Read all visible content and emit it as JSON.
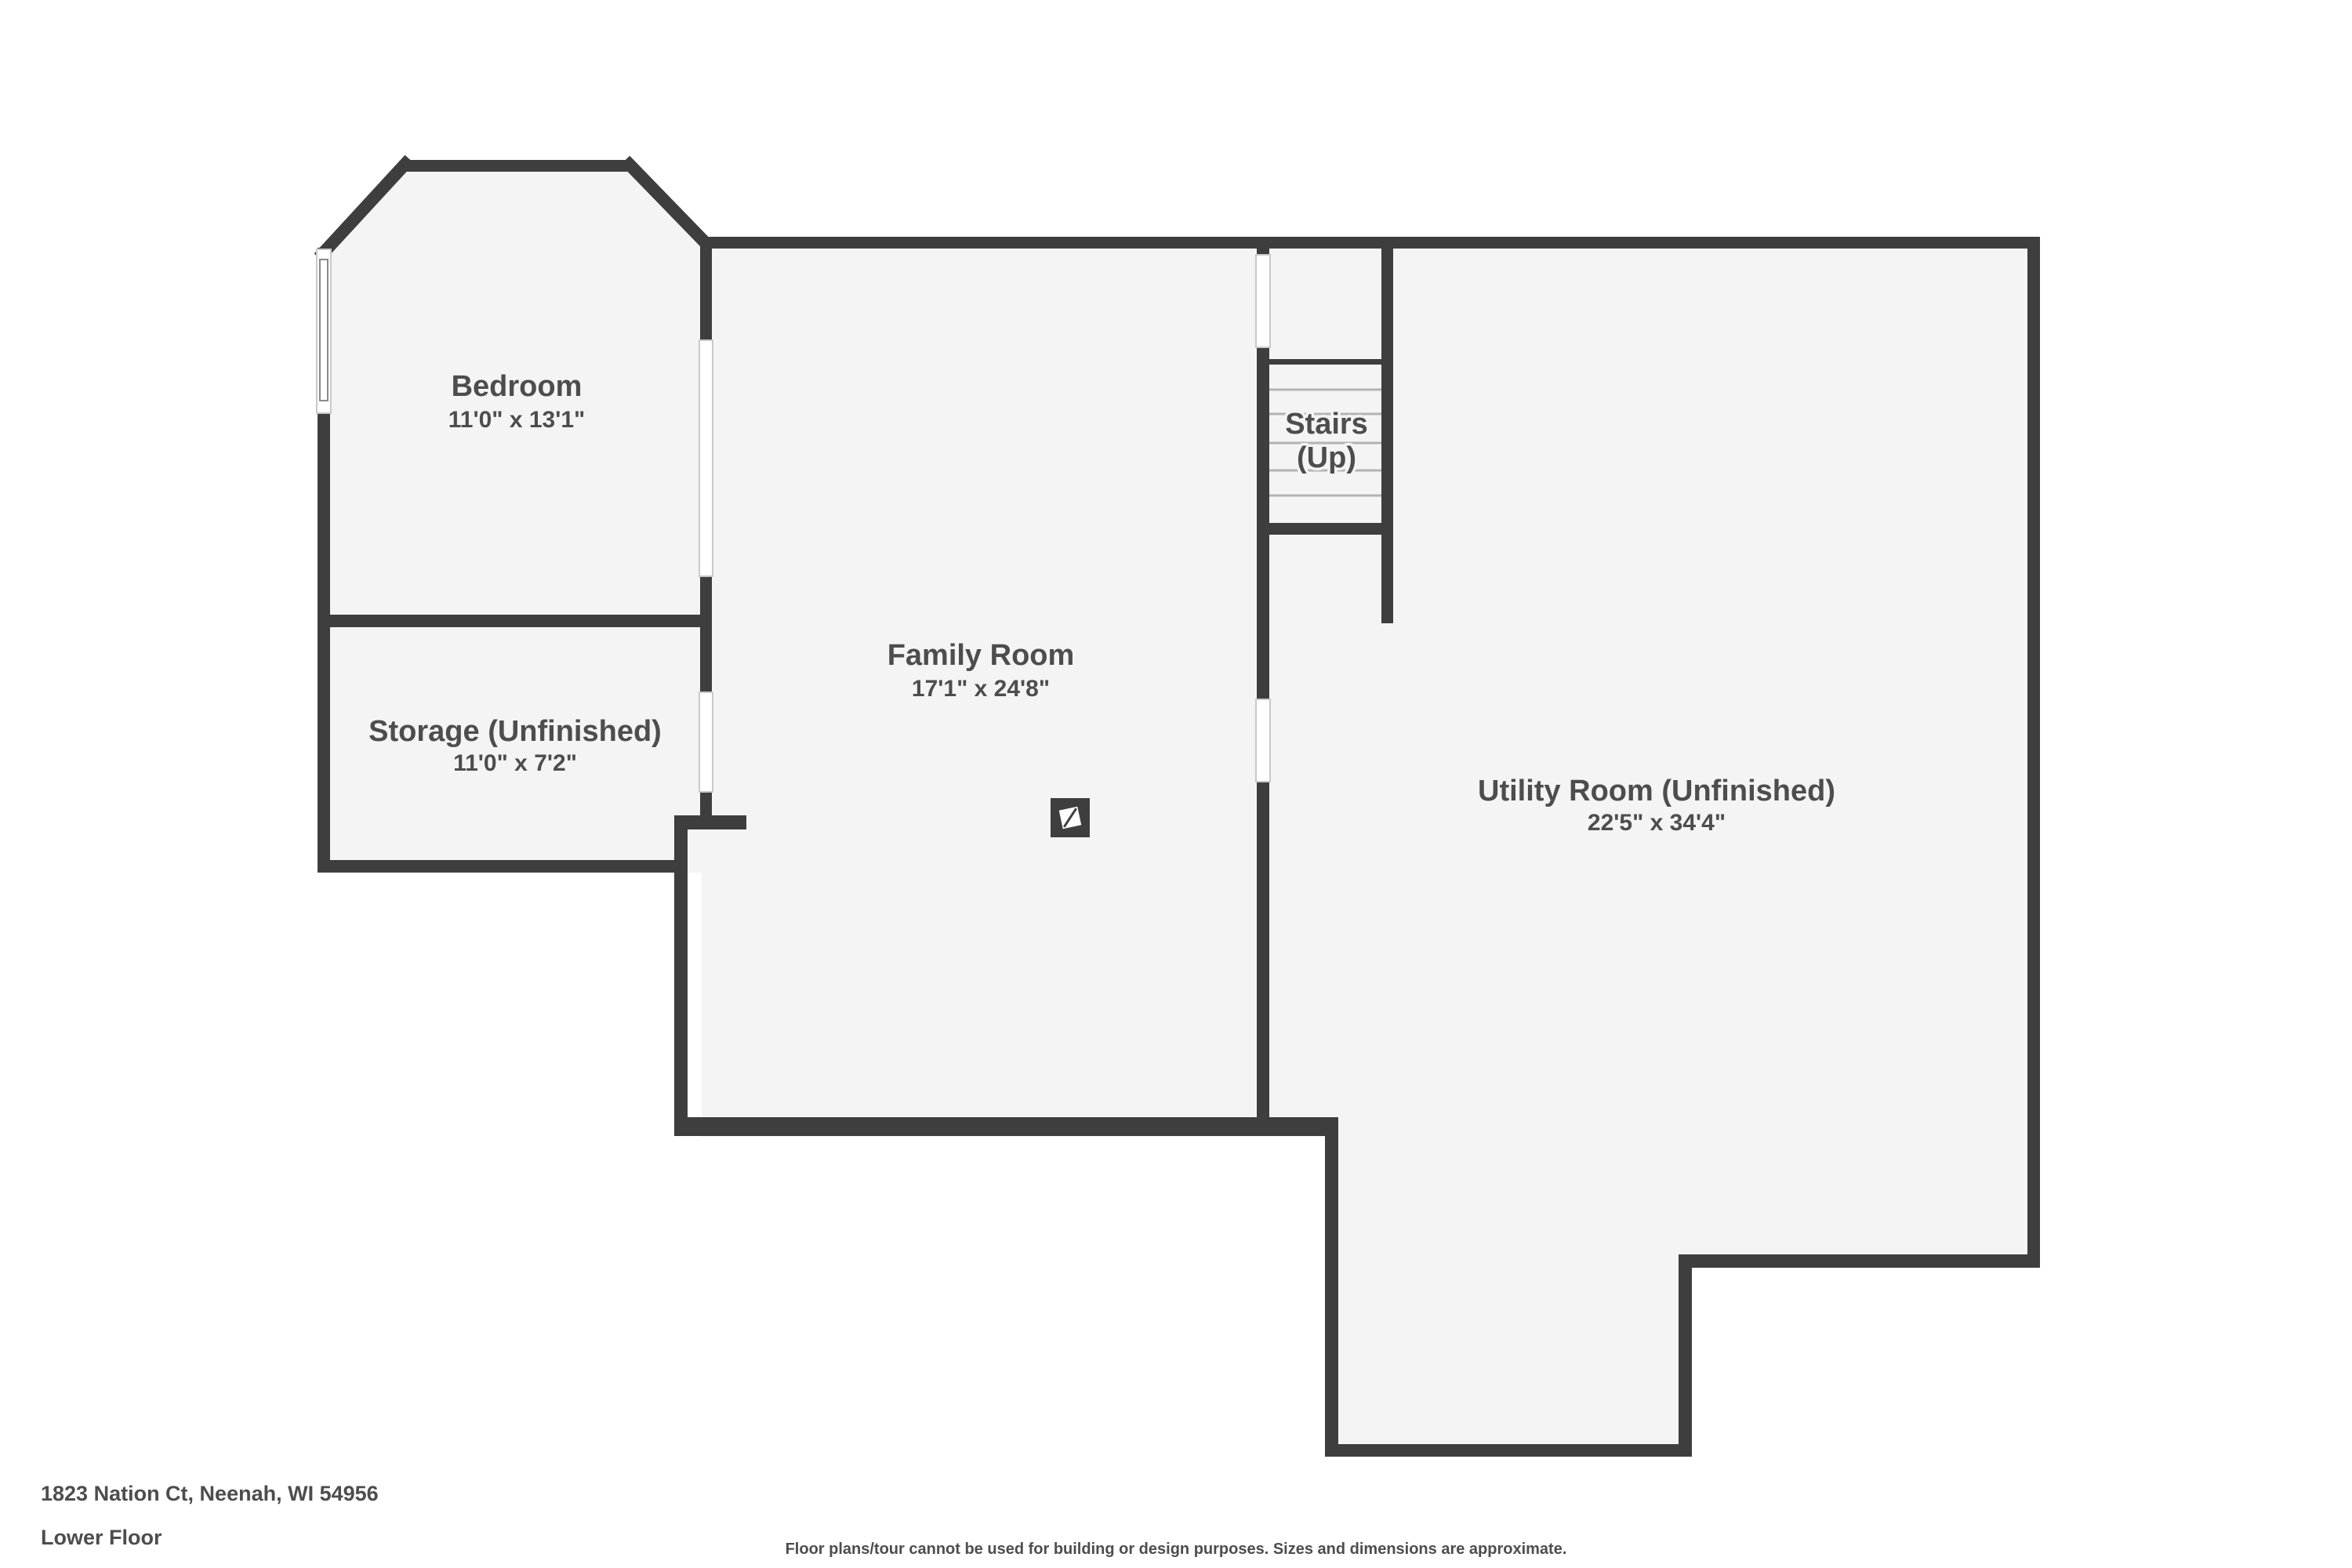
{
  "colors": {
    "wall": "#3e3e3e",
    "floor": "#f4f4f4",
    "label_text": "#4d4d4d",
    "tread_line": "#b3b3b3",
    "opening_outline": "#c9c9c9",
    "background": "#ffffff"
  },
  "rooms": [
    {
      "id": "bedroom",
      "name": "Bedroom",
      "dimensions": "11'0\" x 13'1\""
    },
    {
      "id": "storage",
      "name": "Storage (Unfinished)",
      "dimensions": "11'0\" x 7'2\""
    },
    {
      "id": "family-room",
      "name": "Family Room",
      "dimensions": "17'1\" x 24'8\""
    },
    {
      "id": "stairs",
      "name": "Stairs",
      "sub": "(Up)"
    },
    {
      "id": "utility-room",
      "name": "Utility Room (Unfinished)",
      "dimensions": "22'5\" x 34'4\""
    }
  ],
  "footer": {
    "address": "1823 Nation Ct, Neenah, WI 54956",
    "floor_label": "Lower Floor",
    "disclaimer": "Floor plans/tour cannot be used for building or design purposes. Sizes and dimensions are approximate."
  }
}
